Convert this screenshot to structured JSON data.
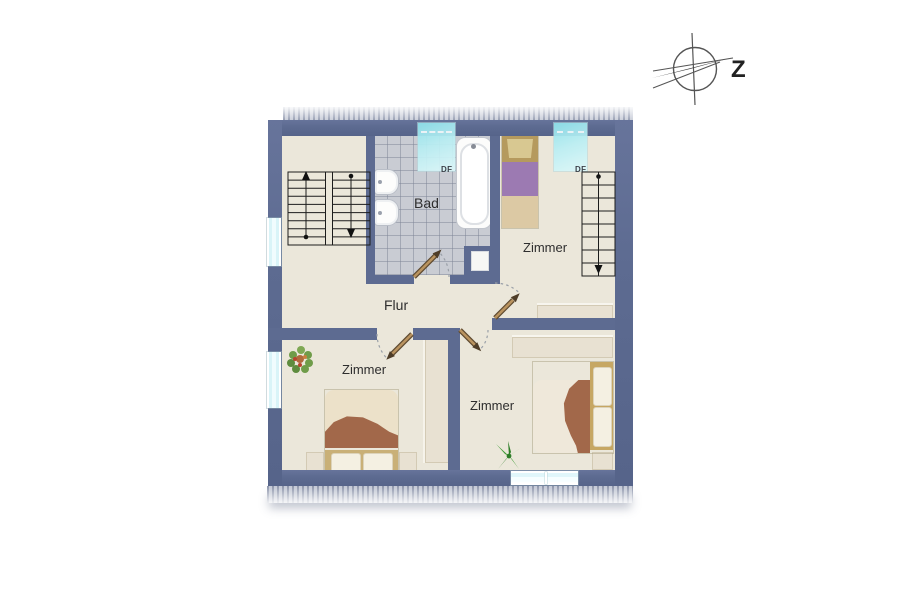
{
  "compass": {
    "label": "Z"
  },
  "rooms": {
    "bathroom": {
      "label": "Bad"
    },
    "hallway": {
      "label": "Flur"
    },
    "bedroom_top_right": {
      "label": "Zimmer"
    },
    "bedroom_bottom_left": {
      "label": "Zimmer"
    },
    "bedroom_bottom_right": {
      "label": "Zimmer"
    }
  },
  "skylights": {
    "bathroom": {
      "label": "DF"
    },
    "bedroom_top_right": {
      "label": "DF"
    }
  },
  "colors": {
    "wall": "#5d6b91",
    "floor": "#ebe7da",
    "bathroom_tiles": "#c9ccd3",
    "window_glass": "#d9f4f8",
    "skylight": "#8fe3ec",
    "door_leaf": "#b9935f",
    "bed_blanket_purple": "#9c7ab2",
    "bed_blanket_brown": "#a2684a",
    "plant_green": "#3f9b35",
    "label_text": "#2e2e2e"
  }
}
